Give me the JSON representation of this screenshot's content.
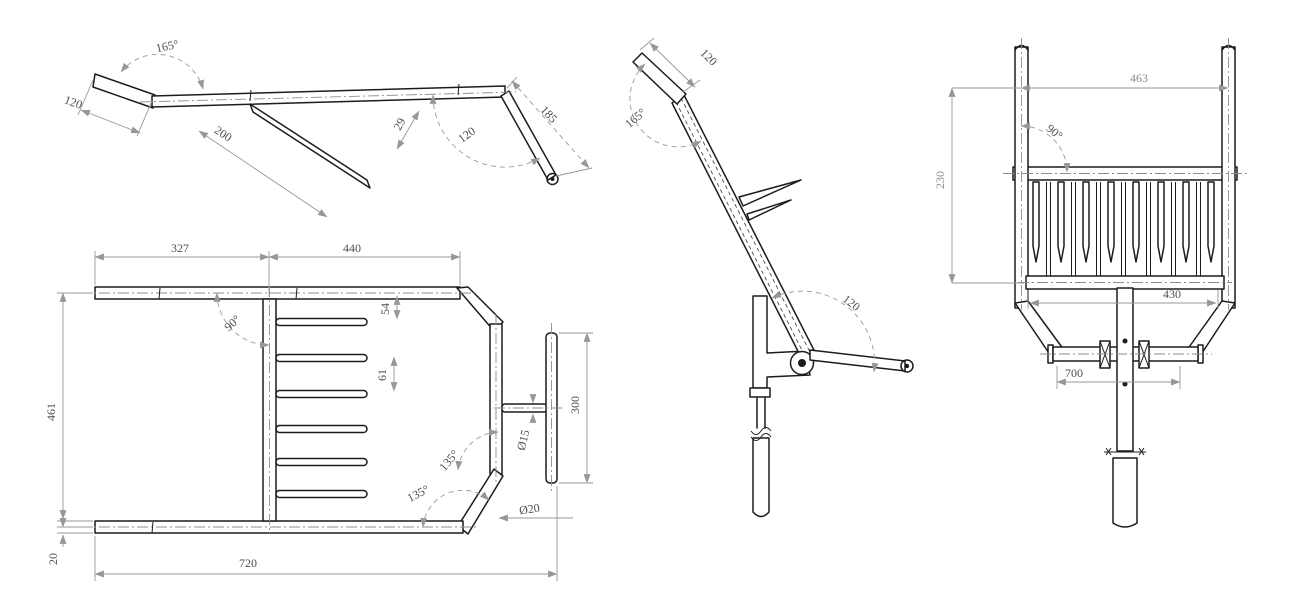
{
  "drawing": {
    "background": "#ffffff",
    "line_color": "#1c1c1c",
    "dim_color": "#979797",
    "views": {
      "side_profile": {
        "name": "side-profile",
        "dims": {
          "bend_angle": "165°",
          "end_segment_length": "120",
          "strut_length": "200",
          "offset": "29",
          "bar_angle": "120",
          "bar_length": "185"
        }
      },
      "plan": {
        "name": "plan",
        "dims": {
          "left_span": "327",
          "right_span": "440",
          "spine_angle": "90°",
          "first_tine_offset": "54",
          "tine_pitch": "61",
          "frame_depth": "461",
          "rail_thickness": "20",
          "overall_width": "720",
          "chamfer_angle_upper": "135°",
          "chamfer_angle_lower": "135°",
          "tube_diameter": "Ø20",
          "crossbar_diameter": "Ø15",
          "handle_length": "300"
        }
      },
      "side_assembled": {
        "name": "side-assembled",
        "dims": {
          "top_segment_length": "120",
          "bend_angle": "165°",
          "lever_angle": "120"
        }
      },
      "front": {
        "name": "front",
        "dims": {
          "post_span": "463",
          "post_angle": "90°",
          "basket_depth": "230",
          "tine_bar_width": "430",
          "axle_width": "700"
        }
      }
    }
  }
}
